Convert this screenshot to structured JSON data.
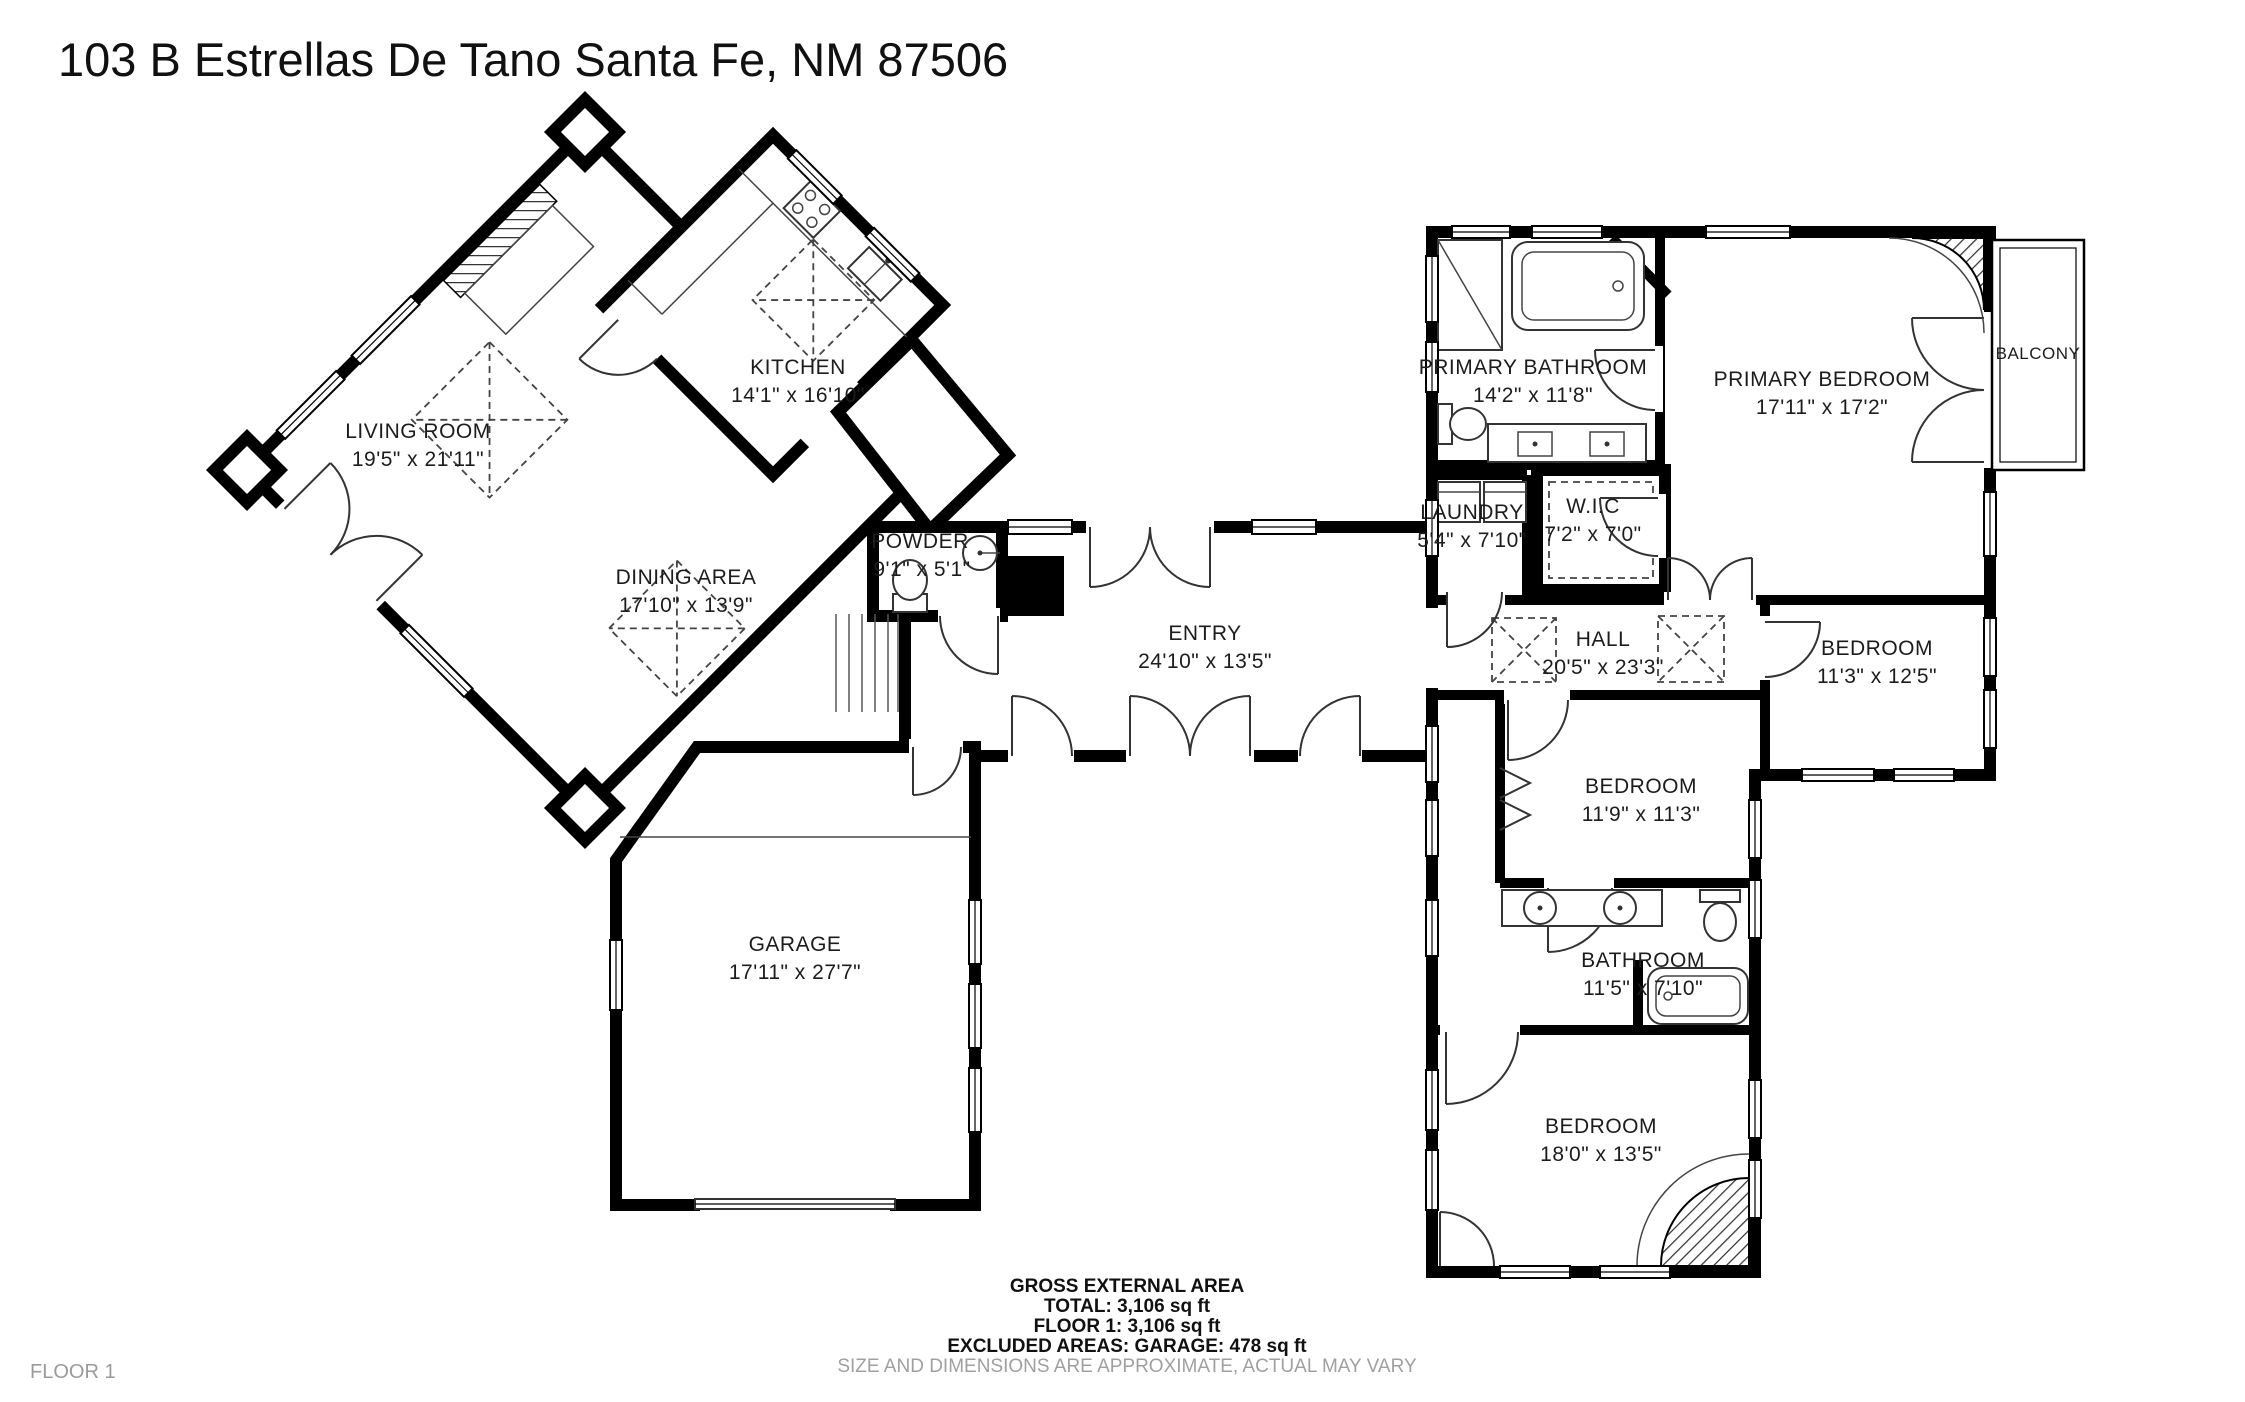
{
  "title": "103 B Estrellas De Tano Santa Fe, NM 87506",
  "floor_label": "FLOOR 1",
  "rooms": {
    "living_room": {
      "name": "LIVING ROOM",
      "dims": "19'5\" x 21'11\""
    },
    "kitchen": {
      "name": "KITCHEN",
      "dims": "14'1\" x 16'10\""
    },
    "dining_area": {
      "name": "DINING AREA",
      "dims": "17'10\" x 13'9\""
    },
    "powder": {
      "name": "POWDER",
      "dims": "9'1\" x 5'1\""
    },
    "entry": {
      "name": "ENTRY",
      "dims": "24'10\" x 13'5\""
    },
    "garage": {
      "name": "GARAGE",
      "dims": "17'11\" x 27'7\""
    },
    "primary_bathroom": {
      "name": "PRIMARY BATHROOM",
      "dims": "14'2\" x 11'8\""
    },
    "primary_bedroom": {
      "name": "PRIMARY BEDROOM",
      "dims": "17'11\" x 17'2\""
    },
    "balcony": {
      "name": "BALCONY"
    },
    "laundry": {
      "name": "LAUNDRY",
      "dims": "5'4\" x 7'10\""
    },
    "wic": {
      "name": "W.I.C",
      "dims": "7'2\" x 7'0\""
    },
    "hall": {
      "name": "HALL",
      "dims": "20'5\" x 23'3\""
    },
    "bedroom_right": {
      "name": "BEDROOM",
      "dims": "11'3\" x 12'5\""
    },
    "bedroom_middle": {
      "name": "BEDROOM",
      "dims": "11'9\" x 11'3\""
    },
    "bathroom": {
      "name": "BATHROOM",
      "dims": "11'5\" x 7'10\""
    },
    "bedroom_bottom": {
      "name": "BEDROOM",
      "dims": "18'0\" x 13'5\""
    }
  },
  "footer": {
    "heading": "GROSS EXTERNAL AREA",
    "total": "TOTAL: 3,106 sq ft",
    "floor": "FLOOR 1: 3,106 sq ft",
    "excluded": "EXCLUDED AREAS: GARAGE: 478 sq ft",
    "disclaimer": "SIZE AND DIMENSIONS ARE APPROXIMATE, ACTUAL MAY VARY"
  },
  "colors": {
    "wall": "#000000",
    "text": "#1c1c1c",
    "muted": "#9a9a9a"
  }
}
